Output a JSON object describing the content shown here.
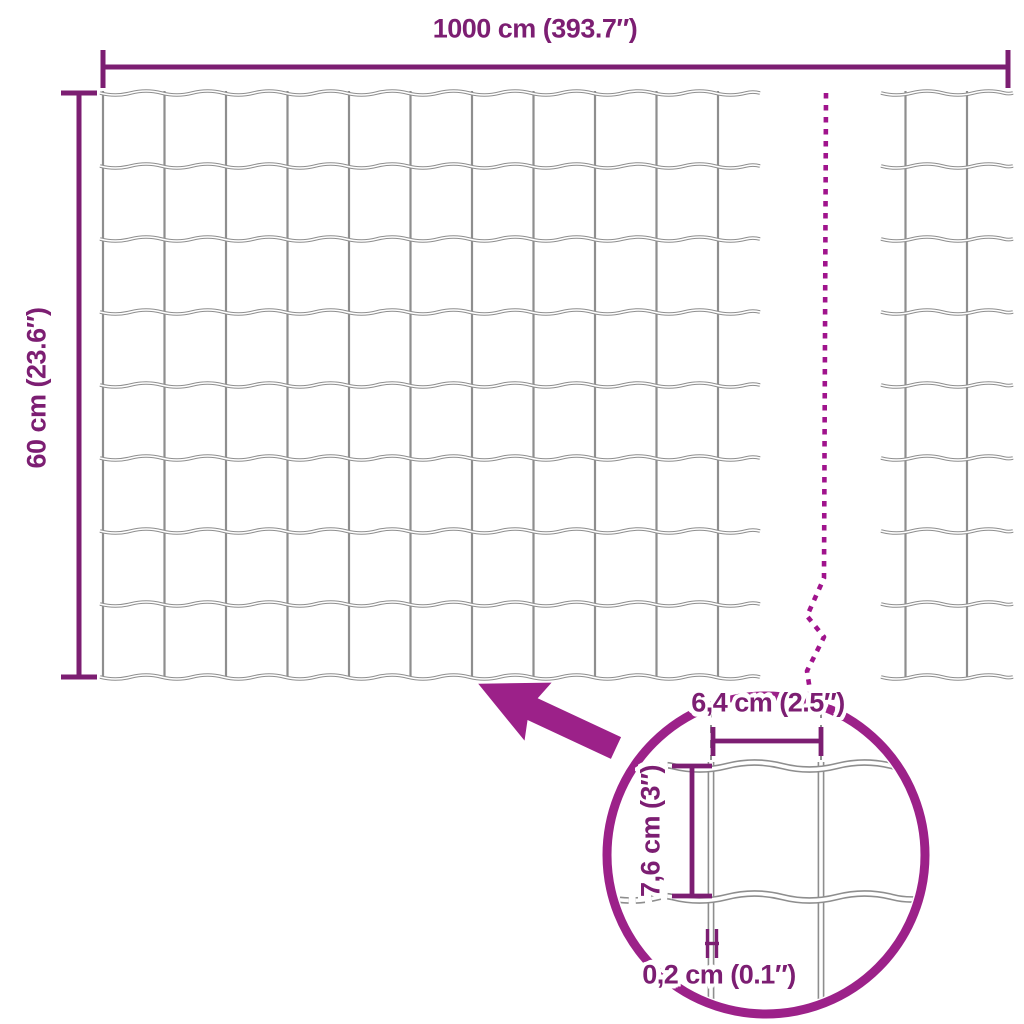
{
  "diagram": {
    "kind": "garden-fence-wire-mesh-dimension-diagram",
    "overall": {
      "width_label": "1000 cm (393.7″)",
      "height_label": "60 cm (23.6″)"
    },
    "detail": {
      "mesh_width_label": "6,4 cm (2.5″)",
      "mesh_height_label": "7,6 cm (3″)",
      "wire_thickness_label": "0,2 cm (0.1″)"
    },
    "colors": {
      "dimension": "#7c1e72",
      "accent": "#9c2189",
      "dash": "#a0138c",
      "wire": "#8e8e8e",
      "background": "#ffffff"
    }
  }
}
